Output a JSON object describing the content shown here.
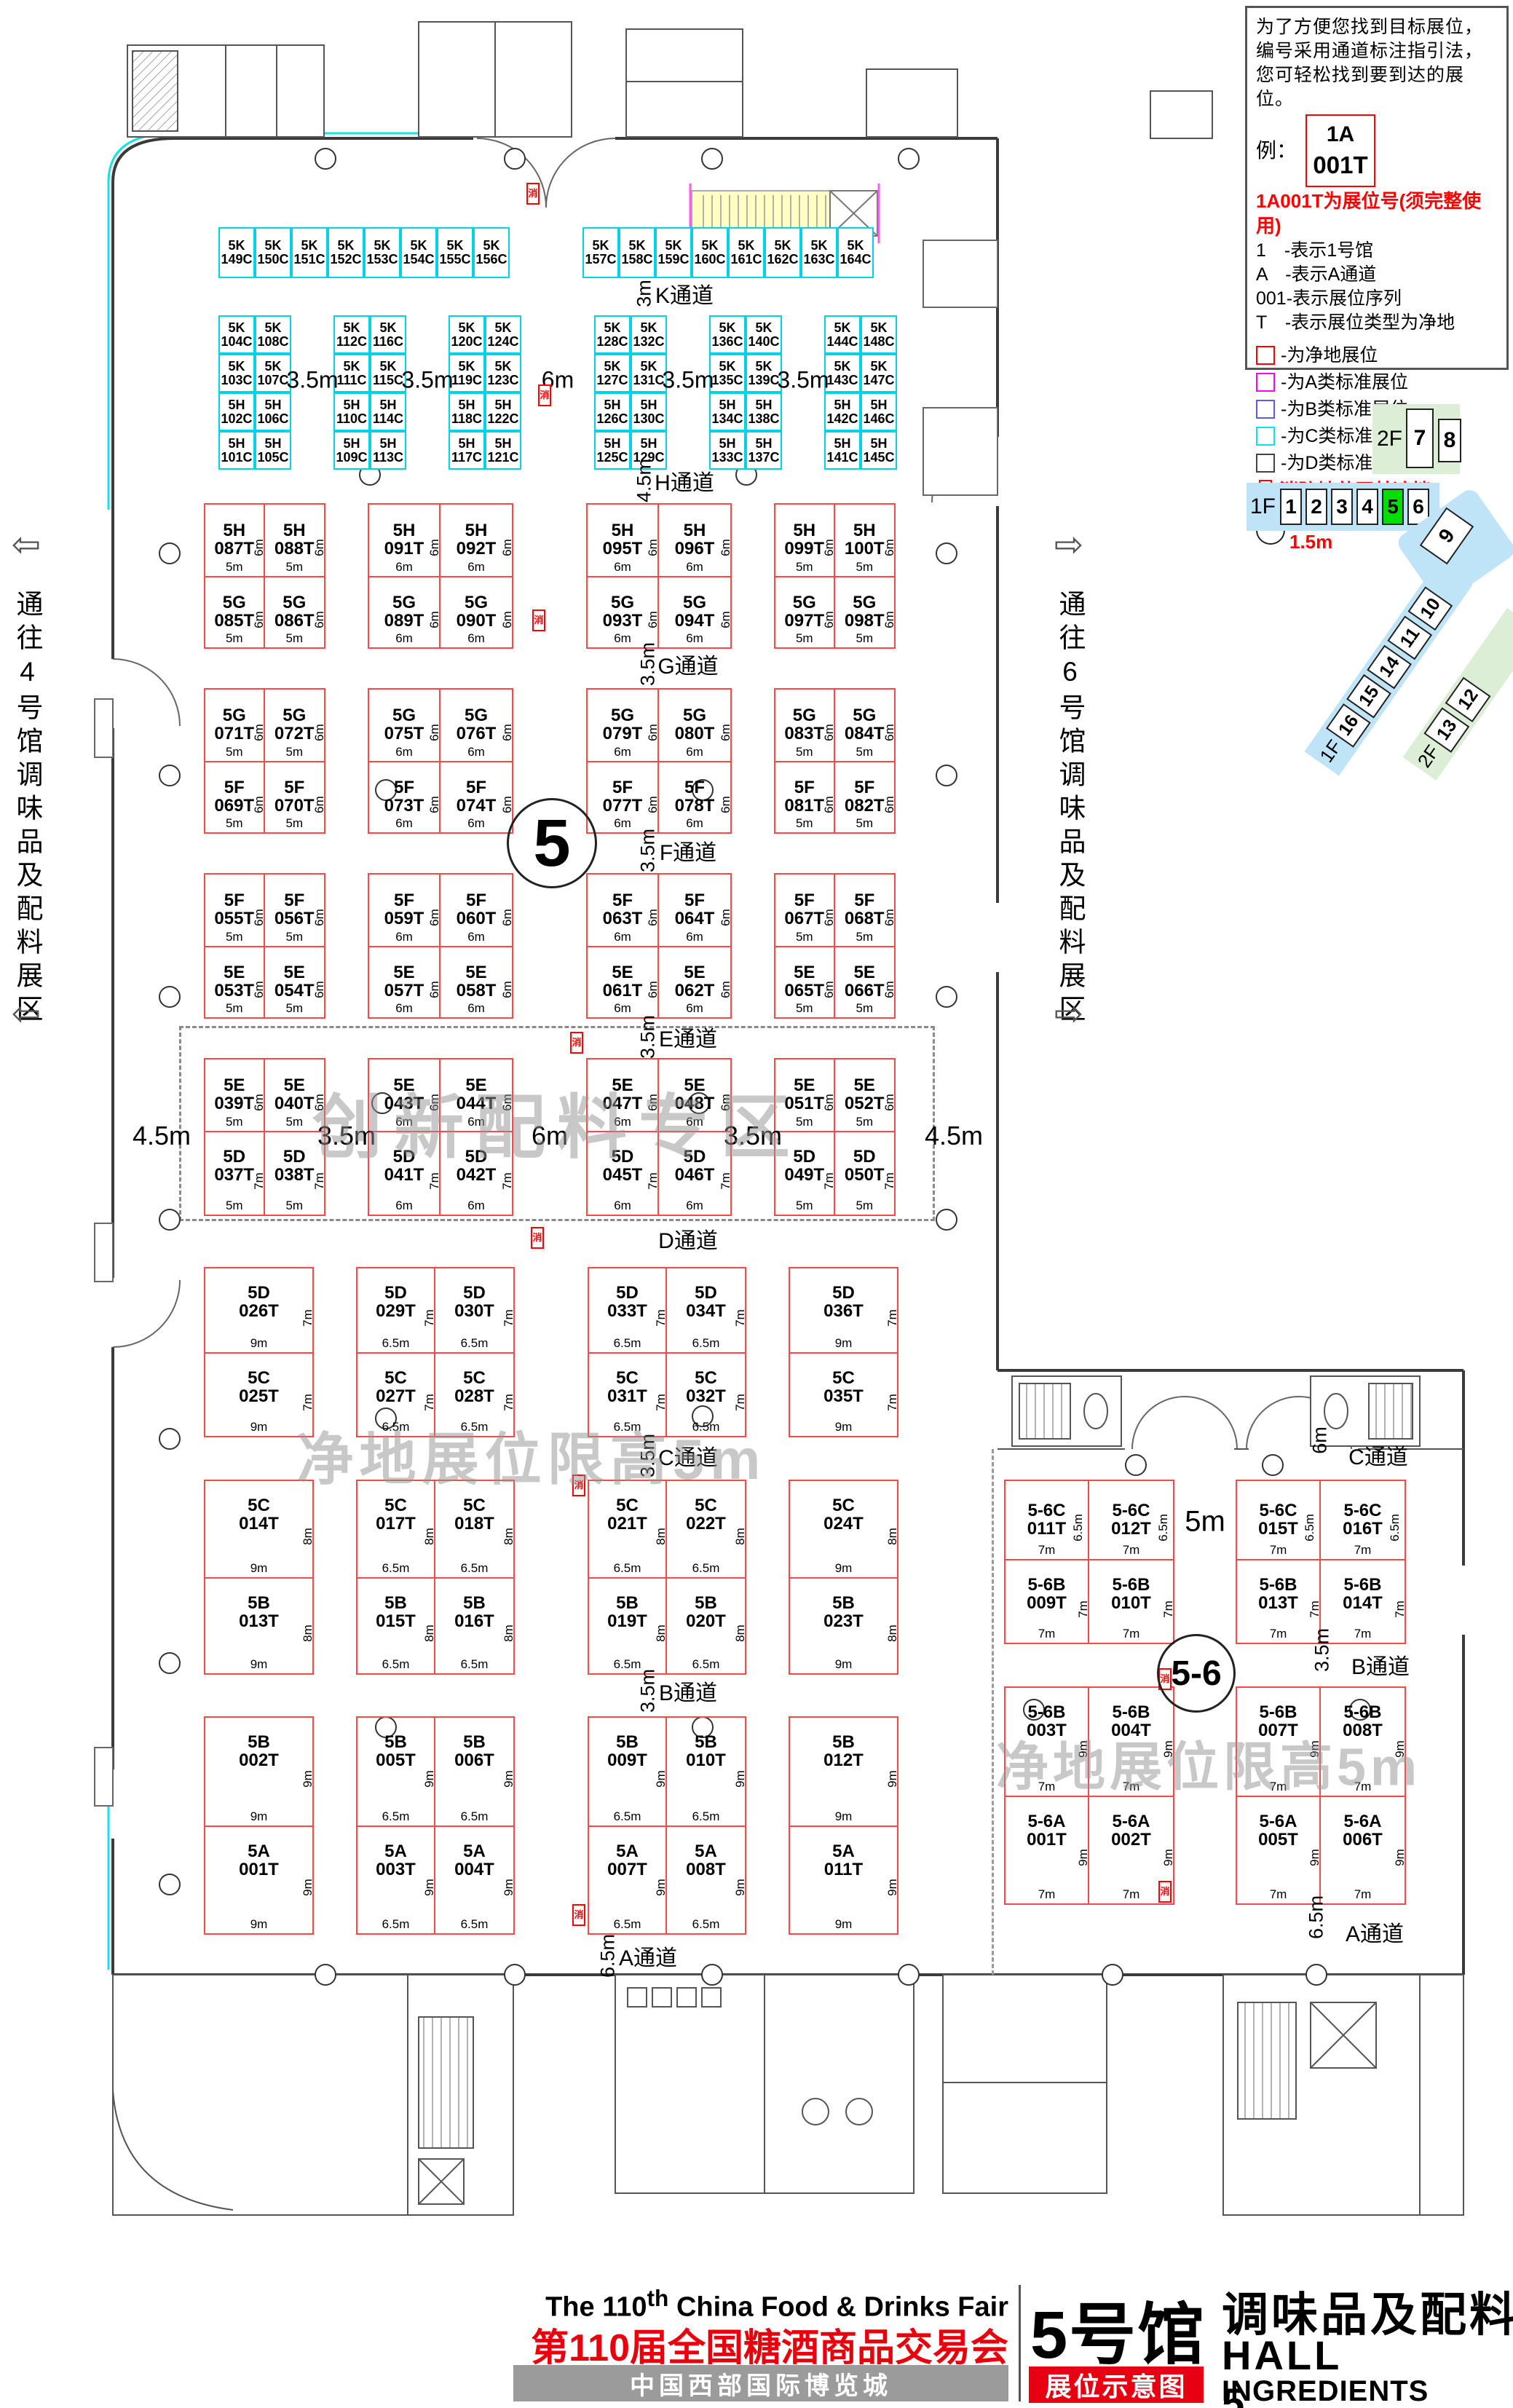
{
  "legend": {
    "intro": "为了方便您找到目标展位，编号采用通道标注指引法，您可轻松找到要到达的展位。",
    "example_label": "例：",
    "example_box": {
      "line1": "1A",
      "line2": "001T"
    },
    "headline": "1A001T为展位号(须完整使用)",
    "lines": [
      "1　-表示1号馆",
      "A　-表示A通道",
      "001-表示展位序列",
      "T　-表示展位类型为净地"
    ],
    "types": [
      {
        "color": "#ff0000",
        "label": "-为净地展位"
      },
      {
        "color": "#ff00ff",
        "label": "-为A类标准展位"
      },
      {
        "color": "#5a5af0",
        "label": "-为B类标准展位"
      },
      {
        "color": "#00e5ee",
        "label": "-为C类标准展位"
      },
      {
        "color": "#444444",
        "label": "-为D类标准展位"
      }
    ],
    "fire_note": "消防地井严禁遮挡",
    "pillar_note": "展位内立柱 直径均为1.5m"
  },
  "navigator": {
    "f2_label": "2F",
    "f2_halls": [
      "7",
      "8"
    ],
    "f1_label": "1F",
    "f1_halls": [
      "1",
      "2",
      "3",
      "4",
      "5",
      "6"
    ],
    "highlight_hall": "5",
    "hall9": "9",
    "diag_halls": [
      "10",
      "11",
      "14",
      "15",
      "16"
    ],
    "diag_label": "1F",
    "green_halls": [
      "12",
      "13"
    ],
    "green_label": "2F",
    "blue": "#bfe3f7",
    "green_bg": "#ddeed6",
    "highlight_green": "#00dd00"
  },
  "map": {
    "side_left": {
      "text": "通往4号馆调味品及配料展区",
      "arrow_glyph": "⇦"
    },
    "side_right": {
      "text": "通往6号馆调味品及配料展区",
      "arrow_glyph": "⇨"
    },
    "hall_circle_main": "5",
    "hall_circle_wing": "5-6",
    "watermark_zone": "创新配料专区",
    "watermark_left": "净地展位限高5m",
    "watermark_right": "净地展位限高5m",
    "fire_glyph": "消",
    "aisles_left": [
      {
        "name": "K通道",
        "dim": "3m"
      },
      {
        "name": "H通道",
        "dim": "4.5m"
      },
      {
        "name": "G通道",
        "dim": "3.5m"
      },
      {
        "name": "F通道",
        "dim": "3.5m"
      },
      {
        "name": "E通道",
        "dim": "3.5m"
      },
      {
        "name": "D通道",
        "dim": ""
      },
      {
        "name": "C通道",
        "dim": "3.5m"
      },
      {
        "name": "B通道",
        "dim": "3.5m"
      },
      {
        "name": "A通道",
        "dim": "6.5m"
      }
    ],
    "aisles_right": [
      {
        "name": "C通道",
        "dim": "6m"
      },
      {
        "name": "B通道",
        "dim": "3.5m"
      },
      {
        "name": "A通道",
        "dim": "6.5m"
      }
    ],
    "k_gap_dims": [
      "3.5m",
      "3.5m",
      "6m",
      "3.5m",
      "3.5m"
    ],
    "ed_dims": {
      "left": "4.5m",
      "right": "4.5m",
      "gaps": [
        "3.5m",
        "6m",
        "3.5m"
      ]
    },
    "wing_gap_dim": "5m",
    "k_top_left": [
      "5K 149C",
      "5K 150C",
      "5K 151C",
      "5K 152C",
      "5K 153C",
      "5K 154C",
      "5K 155C",
      "5K 156C"
    ],
    "k_top_right": [
      "5K 157C",
      "5K 158C",
      "5K 159C",
      "5K 160C",
      "5K 161C",
      "5K 162C",
      "5K 163C",
      "5K 164C"
    ],
    "k_columns": [
      [
        [
          "5K 104C",
          "5K 108C"
        ],
        [
          "5K 103C",
          "5K 107C"
        ],
        [
          "5H 102C",
          "5H 106C"
        ],
        [
          "5H 101C",
          "5H 105C"
        ]
      ],
      [
        [
          "5K 112C",
          "5K 116C"
        ],
        [
          "5K 111C",
          "5K 115C"
        ],
        [
          "5H 110C",
          "5H 114C"
        ],
        [
          "5H 109C",
          "5H 113C"
        ]
      ],
      [
        [
          "5K 120C",
          "5K 124C"
        ],
        [
          "5K 119C",
          "5K 123C"
        ],
        [
          "5H 118C",
          "5H 122C"
        ],
        [
          "5H 117C",
          "5H 121C"
        ]
      ],
      [
        [
          "5K 128C",
          "5K 132C"
        ],
        [
          "5K 127C",
          "5K 131C"
        ],
        [
          "5H 126C",
          "5H 130C"
        ],
        [
          "5H 125C",
          "5H 129C"
        ]
      ],
      [
        [
          "5K 136C",
          "5K 140C"
        ],
        [
          "5K 135C",
          "5K 139C"
        ],
        [
          "5H 134C",
          "5H 138C"
        ],
        [
          "5H 133C",
          "5H 137C"
        ]
      ],
      [
        [
          "5K 144C",
          "5K 148C"
        ],
        [
          "5K 143C",
          "5K 147C"
        ],
        [
          "5H 142C",
          "5H 146C"
        ],
        [
          "5H 141C",
          "5H 145C"
        ]
      ]
    ],
    "bands_left": [
      {
        "key": "HG",
        "hTop": "6m",
        "hBot": "6m",
        "groups": [
          {
            "w": "5m",
            "top": [
              "5H 087T",
              "5H 088T"
            ],
            "bot": [
              "5G 085T",
              "5G 086T"
            ]
          },
          {
            "w": "6m",
            "top": [
              "5H 091T",
              "5H 092T"
            ],
            "bot": [
              "5G 089T",
              "5G 090T"
            ]
          },
          {
            "w": "6m",
            "top": [
              "5H 095T",
              "5H 096T"
            ],
            "bot": [
              "5G 093T",
              "5G 094T"
            ]
          },
          {
            "w": "5m",
            "top": [
              "5H 099T",
              "5H 100T"
            ],
            "bot": [
              "5G 097T",
              "5G 098T"
            ]
          }
        ]
      },
      {
        "key": "GF",
        "hTop": "6m",
        "hBot": "6m",
        "groups": [
          {
            "w": "5m",
            "top": [
              "5G 071T",
              "5G 072T"
            ],
            "bot": [
              "5F 069T",
              "5F 070T"
            ]
          },
          {
            "w": "6m",
            "top": [
              "5G 075T",
              "5G 076T"
            ],
            "bot": [
              "5F 073T",
              "5F 074T"
            ]
          },
          {
            "w": "6m",
            "top": [
              "5G 079T",
              "5G 080T"
            ],
            "bot": [
              "5F 077T",
              "5F 078T"
            ]
          },
          {
            "w": "5m",
            "top": [
              "5G 083T",
              "5G 084T"
            ],
            "bot": [
              "5F 081T",
              "5F 082T"
            ]
          }
        ]
      },
      {
        "key": "FE",
        "hTop": "6m",
        "hBot": "6m",
        "groups": [
          {
            "w": "5m",
            "top": [
              "5F 055T",
              "5F 056T"
            ],
            "bot": [
              "5E 053T",
              "5E 054T"
            ]
          },
          {
            "w": "6m",
            "top": [
              "5F 059T",
              "5F 060T"
            ],
            "bot": [
              "5E 057T",
              "5E 058T"
            ]
          },
          {
            "w": "6m",
            "top": [
              "5F 063T",
              "5F 064T"
            ],
            "bot": [
              "5E 061T",
              "5E 062T"
            ]
          },
          {
            "w": "5m",
            "top": [
              "5F 067T",
              "5F 068T"
            ],
            "bot": [
              "5E 065T",
              "5E 066T"
            ]
          }
        ]
      },
      {
        "key": "ED",
        "hTop": "6m",
        "hBot": "7m",
        "groups": [
          {
            "w": "5m",
            "top": [
              "5E 039T",
              "5E 040T"
            ],
            "bot": [
              "5D 037T",
              "5D 038T"
            ]
          },
          {
            "w": "6m",
            "top": [
              "5E 043T",
              "5E 044T"
            ],
            "bot": [
              "5D 041T",
              "5D 042T"
            ]
          },
          {
            "w": "6m",
            "top": [
              "5E 047T",
              "5E 048T"
            ],
            "bot": [
              "5D 045T",
              "5D 046T"
            ]
          },
          {
            "w": "5m",
            "top": [
              "5E 051T",
              "5E 052T"
            ],
            "bot": [
              "5D 049T",
              "5D 050T"
            ]
          }
        ]
      },
      {
        "key": "DC",
        "hTop": "7m",
        "hBot": "7m",
        "groups": [
          {
            "w": "9m",
            "top": [
              "5D 026T"
            ],
            "bot": [
              "5C 025T"
            ]
          },
          {
            "w": "6.5m",
            "top": [
              "5D 029T",
              "5D 030T"
            ],
            "bot": [
              "5C 027T",
              "5C 028T"
            ]
          },
          {
            "w": "6.5m",
            "top": [
              "5D 033T",
              "5D 034T"
            ],
            "bot": [
              "5C 031T",
              "5C 032T"
            ]
          },
          {
            "w": "9m",
            "top": [
              "5D 036T"
            ],
            "bot": [
              "5C 035T"
            ]
          }
        ]
      },
      {
        "key": "CB",
        "hTop": "8m",
        "hBot": "8m",
        "groups": [
          {
            "w": "9m",
            "top": [
              "5C 014T"
            ],
            "bot": [
              "5B 013T"
            ]
          },
          {
            "w": "6.5m",
            "top": [
              "5C 017T",
              "5C 018T"
            ],
            "bot": [
              "5B 015T",
              "5B 016T"
            ]
          },
          {
            "w": "6.5m",
            "top": [
              "5C 021T",
              "5C 022T"
            ],
            "bot": [
              "5B 019T",
              "5B 020T"
            ]
          },
          {
            "w": "9m",
            "top": [
              "5C 024T"
            ],
            "bot": [
              "5B 023T"
            ]
          }
        ]
      },
      {
        "key": "BA",
        "hTop": "9m",
        "hBot": "9m",
        "groups": [
          {
            "w": "9m",
            "top": [
              "5B 002T"
            ],
            "bot": [
              "5A 001T"
            ]
          },
          {
            "w": "6.5m",
            "top": [
              "5B 005T",
              "5B 006T"
            ],
            "bot": [
              "5A 003T",
              "5A 004T"
            ]
          },
          {
            "w": "6.5m",
            "top": [
              "5B 009T",
              "5B 010T"
            ],
            "bot": [
              "5A 007T",
              "5A 008T"
            ]
          },
          {
            "w": "9m",
            "top": [
              "5B 012T"
            ],
            "bot": [
              "5A 011T"
            ]
          }
        ]
      }
    ],
    "bands_right": [
      {
        "key": "C56",
        "hTop": "6.5m",
        "hBot": "7m",
        "groups": [
          {
            "w": "7m",
            "top": [
              "5-6C 011T",
              "5-6C 012T"
            ],
            "bot": [
              "5-6B 009T",
              "5-6B 010T"
            ]
          },
          {
            "w": "7m",
            "top": [
              "5-6C 015T",
              "5-6C 016T"
            ],
            "bot": [
              "5-6B 013T",
              "5-6B 014T"
            ]
          }
        ]
      },
      {
        "key": "B56",
        "hTop": "9m",
        "hBot": "9m",
        "groups": [
          {
            "w": "7m",
            "top": [
              "5-6B 003T",
              "5-6B 004T"
            ],
            "bot": [
              "5-6A 001T",
              "5-6A 002T"
            ]
          },
          {
            "w": "7m",
            "top": [
              "5-6B 007T",
              "5-6B 008T"
            ],
            "bot": [
              "5-6A 005T",
              "5-6A 006T"
            ]
          }
        ]
      }
    ]
  },
  "title": {
    "en_pre": "The 110",
    "en_sup": "th",
    "en_post": " China Food & Drinks Fair",
    "cn_red": "第110届全国糖酒商品交易会",
    "venue": "中国西部国际博览城",
    "hall_cn": "5号馆",
    "badge": "展位示意图",
    "cat_cn": "调味品及配料",
    "hall_en": "HALL 5",
    "cat_en": "INGREDIENTS"
  }
}
